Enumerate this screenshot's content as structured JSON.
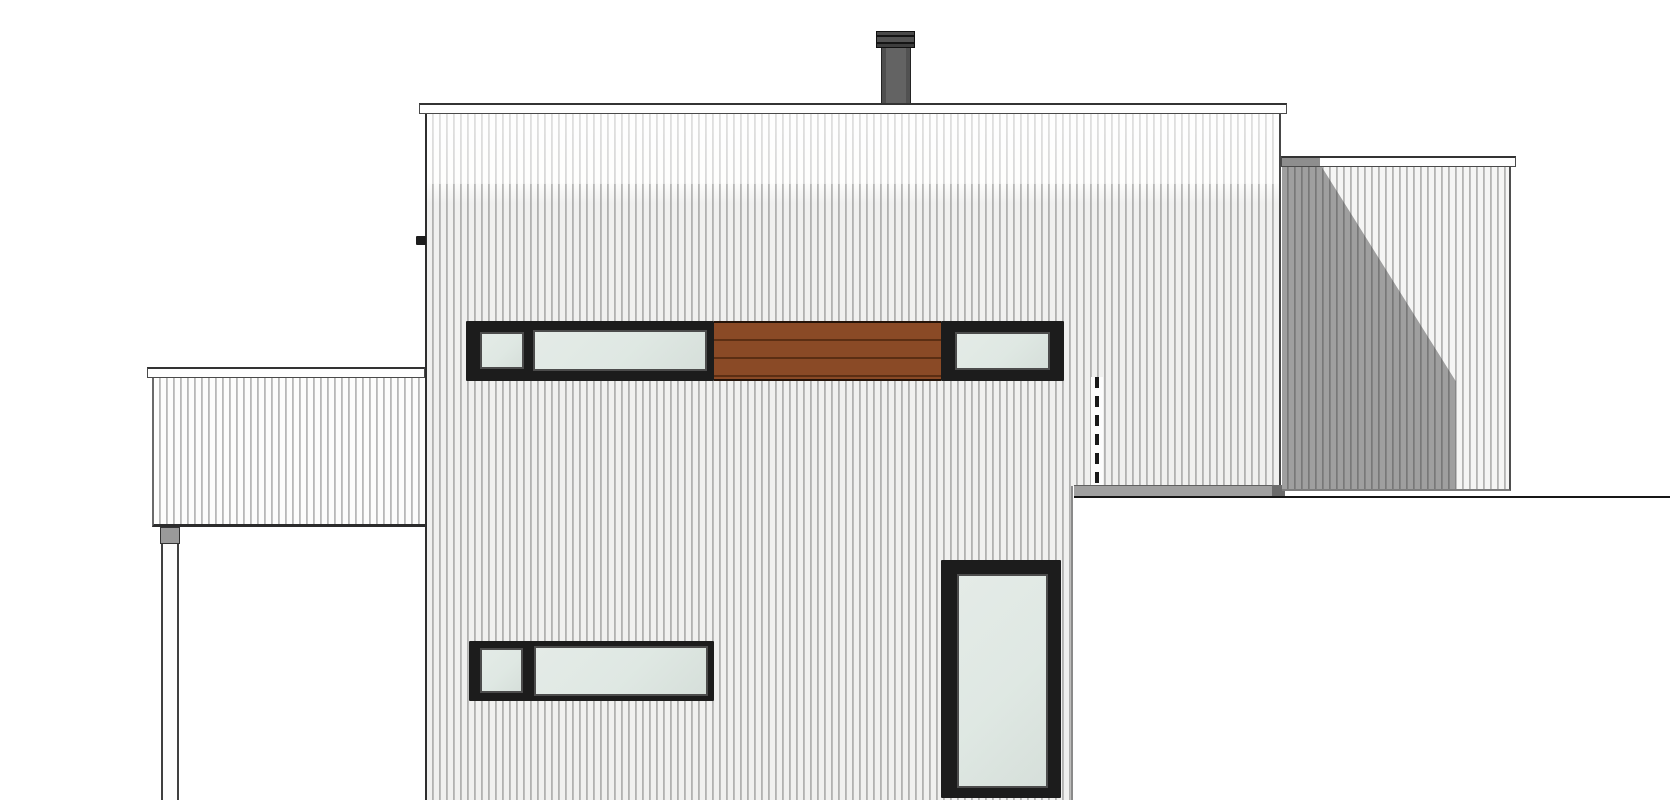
{
  "meta": {
    "type": "architectural-elevation-drawing",
    "text_content": "none"
  },
  "colors": {
    "background": "#ffffff",
    "siding_face": "#fdfdfc",
    "siding_line": "#8e8e8e",
    "fascia": "#fefefe",
    "outline": "#333333",
    "frame_dark": "#1c1c1c",
    "frame_bevel": "#4c4c4c",
    "glass": "#dfe8e3",
    "wood": "#8a4a26",
    "wood_line": "#5b2e13",
    "shadow": "#9a9a9a",
    "parapet": "#a0a0a0",
    "chimney_body": "#5d5d5d",
    "chimney_cap": "#3c3c3c"
  },
  "parts": {
    "chimney": {
      "fill": "chimney_body",
      "cap_fill": "chimney_cap"
    },
    "main_building": {
      "cladding": "vertical-siding",
      "fill": "siding_face"
    },
    "upper_window_band": {
      "panes": 3,
      "glass": "glass",
      "frame": "frame_dark"
    },
    "wood_slat_panel": {
      "fill": "wood",
      "slat_lines": 3
    },
    "tall_window": {
      "glass": "glass",
      "frame": "frame_dark"
    },
    "lower_window_band": {
      "panes": 2,
      "glass": "glass",
      "frame": "frame_dark"
    },
    "hidden_edge_dashed_line": {
      "style": "dashed",
      "color": "#181818"
    },
    "right_wing": {
      "cladding": "vertical-siding",
      "cast_shadow": "shadow"
    },
    "left_wing_canopy": {
      "cladding": "vertical-siding",
      "support_post": true
    },
    "foreground_volume": {
      "fill": "background"
    }
  }
}
